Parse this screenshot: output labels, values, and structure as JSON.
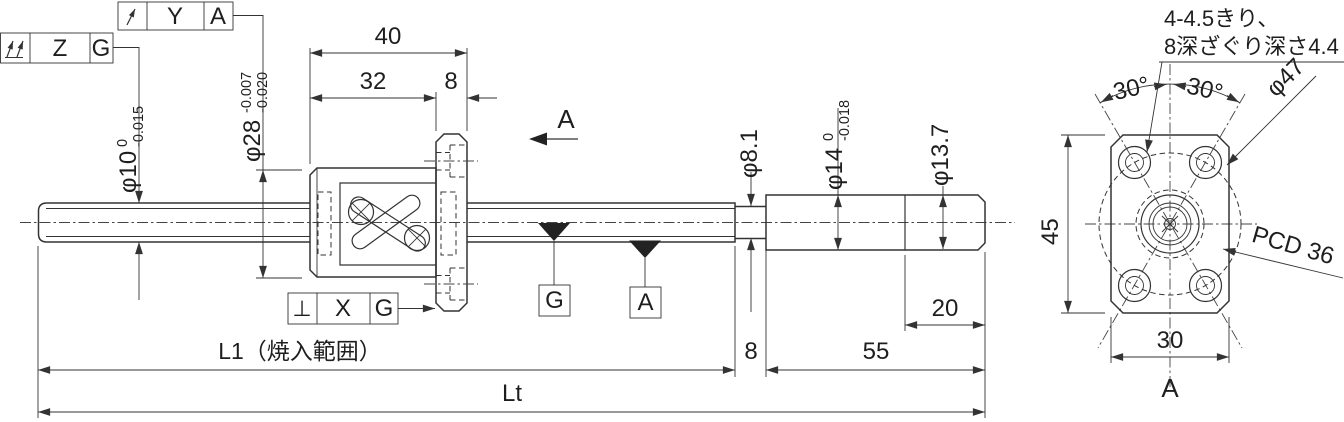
{
  "colors": {
    "line": "#333333",
    "background": "#ffffff"
  },
  "tolerance_frames": {
    "top": {
      "symbol_name": "circular-runout",
      "feature": "Y",
      "datum": "A"
    },
    "left": {
      "symbol_name": "total-runout",
      "feature": "Z",
      "datum": "G"
    },
    "bottom": {
      "symbol": "⊥",
      "feature": "X",
      "datum": "G"
    }
  },
  "datum_targets": {
    "g": "G",
    "a": "A"
  },
  "section": {
    "arrow_label": "A",
    "view_label": "A"
  },
  "note": {
    "line1": "4-4.5きり、",
    "line2": "8深ざぐり深さ4.4"
  },
  "dims": {
    "d40": "40",
    "d32": "32",
    "d8_top": "8",
    "phi10": {
      "base": "φ10",
      "upper": "0",
      "lower": "-0.015"
    },
    "phi28": {
      "base": "φ28",
      "upper": "-0.007",
      "lower": "-0.020"
    },
    "phi8_1": "φ8.1",
    "phi14": {
      "base": "φ14",
      "upper": "0",
      "lower": "-0.018"
    },
    "phi13_7": "φ13.7",
    "d8_bottom": "8",
    "d55": "55",
    "d20": "20",
    "l1": "L1（焼入範囲）",
    "lt": "Lt",
    "d45": "45",
    "d30": "30",
    "angle_left": "30°",
    "angle_right": "30°",
    "phi47": "φ47",
    "pcd36": "PCD 36"
  }
}
